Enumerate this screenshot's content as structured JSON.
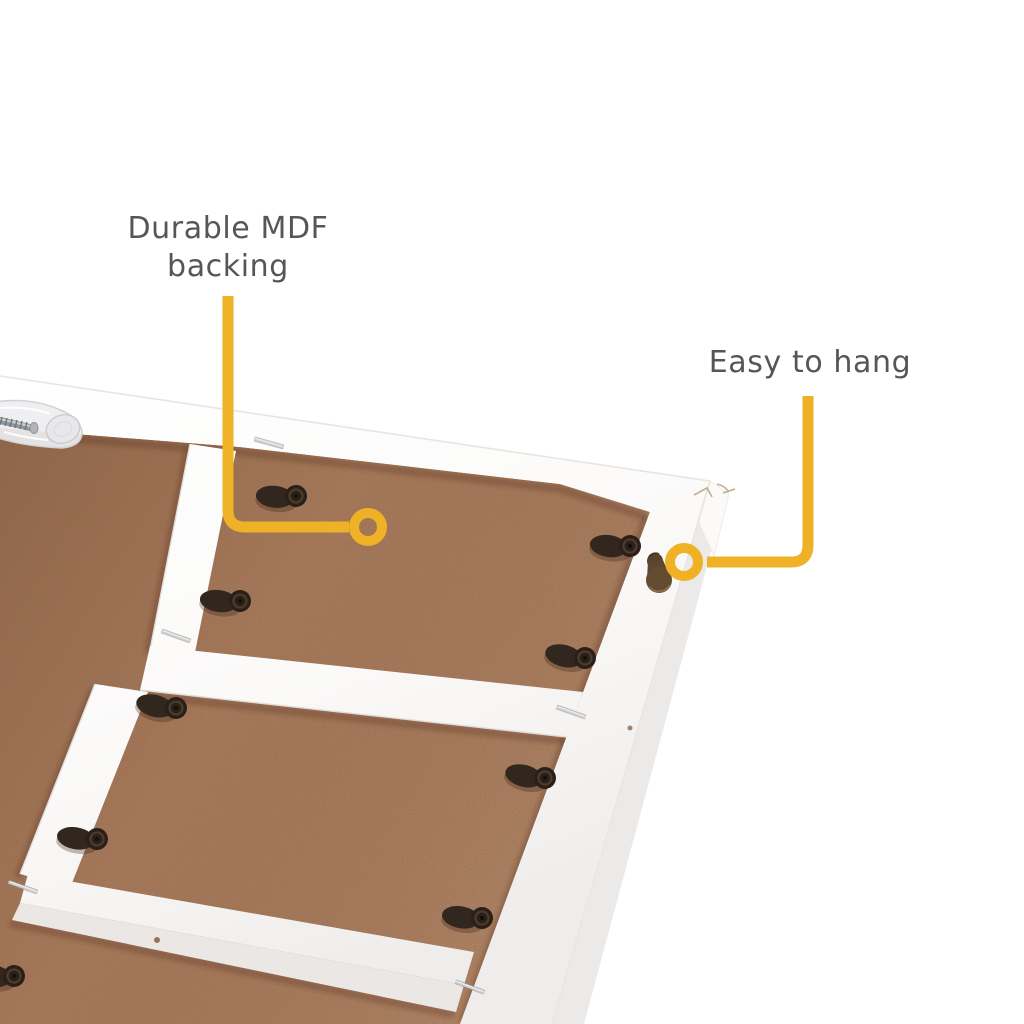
{
  "callouts": {
    "mdf": {
      "label_line1": "Durable MDF",
      "label_line2": "backing"
    },
    "hang": {
      "label": "Easy to hang"
    }
  },
  "colors": {
    "accent": "#EFB226",
    "label_text": "#55565A",
    "background": "#FFFFFF",
    "mdf_brown": "#A6785A",
    "frame_white": "#FCFBFA",
    "clip_black": "#2A2019"
  }
}
